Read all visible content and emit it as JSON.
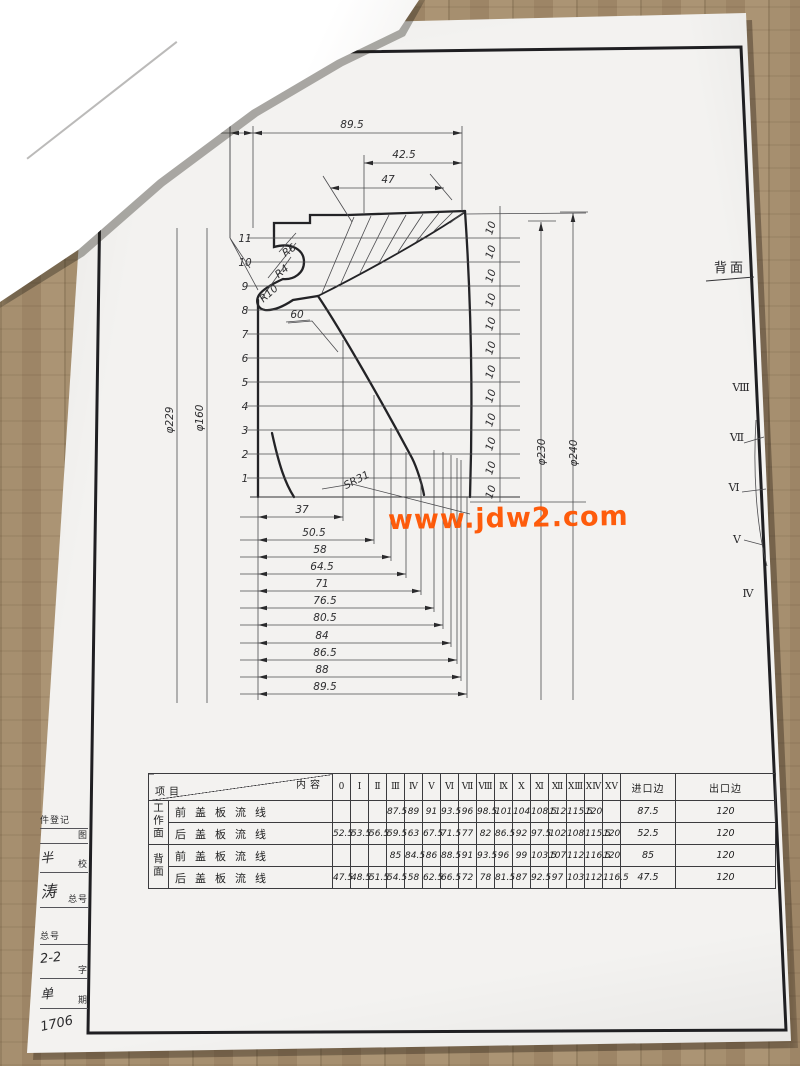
{
  "photo": {
    "wood_color": "#a68f6f",
    "corner_shadow_color": "#63636a",
    "paper_color": "#f3f2f0",
    "ink_color": "#2a2a2c",
    "watermark_color": "#ff5400"
  },
  "corner_label": "YBML.02",
  "watermark": "www.jdw2.com",
  "drawing": {
    "top_dims": {
      "d10": "10",
      "d895": "89.5",
      "d425": "42.5",
      "d47": "47"
    },
    "left_diameters": [
      "φ229",
      "φ160"
    ],
    "right_diameters": [
      "φ230",
      "φ240"
    ],
    "stations": [
      "11",
      "10",
      "9",
      "8",
      "7",
      "6",
      "5",
      "4",
      "3",
      "2",
      "1"
    ],
    "pitch_label": "10",
    "pitch_count": 12,
    "bottom_dims": [
      "37",
      "50.5",
      "58",
      "64.5",
      "71",
      "76.5",
      "80.5",
      "84",
      "86.5",
      "88",
      "89.5"
    ],
    "radius_labels": [
      "R6",
      "R4",
      "R10"
    ],
    "angle_label": "60",
    "sphere_radius_label": "SR31",
    "back_face_label": "背面",
    "section_marks": [
      "Ⅷ",
      "Ⅶ",
      "Ⅵ",
      "Ⅴ",
      "Ⅳ"
    ]
  },
  "table": {
    "corner": {
      "top": "内容",
      "bottom": "项目"
    },
    "columns": [
      "0",
      "Ⅰ",
      "Ⅱ",
      "Ⅲ",
      "Ⅳ",
      "Ⅴ",
      "Ⅵ",
      "Ⅶ",
      "Ⅷ",
      "Ⅸ",
      "Ⅹ",
      "Ⅺ",
      "Ⅻ",
      "ⅩⅢ",
      "ⅩⅣ",
      "ⅩⅤ",
      "进口边",
      "出口边"
    ],
    "groups": [
      {
        "label": "工作面",
        "rows": [
          {
            "label": "前盖板流线",
            "values": [
              "",
              "",
              "",
              "87.5",
              "89",
              "91",
              "93.5",
              "96",
              "98.5",
              "101",
              "104",
              "108.5",
              "112",
              "115.5",
              "120",
              "",
              "87.5",
              "120"
            ]
          },
          {
            "label": "后盖板流线",
            "values": [
              "52.5",
              "53.5",
              "56.5",
              "59.5",
              "63",
              "67.5",
              "71.5",
              "77",
              "82",
              "86.5",
              "92",
              "97.5",
              "102",
              "108",
              "115.5",
              "120",
              "52.5",
              "120"
            ]
          }
        ]
      },
      {
        "label": "背面",
        "rows": [
          {
            "label": "前盖板流线",
            "values": [
              "",
              "",
              "",
              "85",
              "84.5",
              "86",
              "88.5",
              "91",
              "93.5",
              "96",
              "99",
              "103.5",
              "107",
              "112",
              "116.5",
              "120",
              "85",
              "120"
            ]
          },
          {
            "label": "后盖板流线",
            "values": [
              "47.5",
              "48.5",
              "51.5",
              "54.5",
              "58",
              "62.5",
              "66.5",
              "72",
              "78",
              "81.5",
              "87",
              "92.5",
              "97",
              "103",
              "112",
              "116.5",
              "47.5",
              "120"
            ]
          }
        ]
      }
    ]
  },
  "title_stamp": [
    "件登记",
    "图",
    "半",
    "校",
    "涛",
    "总号",
    "总号",
    "2-2",
    "字",
    "单",
    "期",
    "1706"
  ]
}
